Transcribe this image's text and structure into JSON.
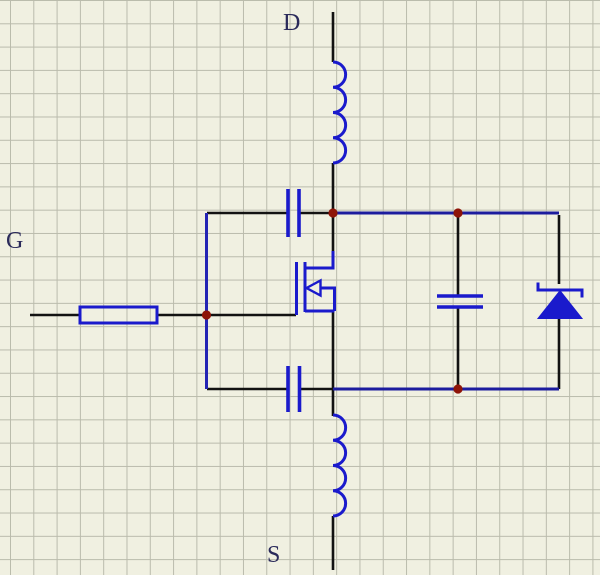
{
  "labels": {
    "drain": "D",
    "gate": "G",
    "source": "S"
  },
  "colors": {
    "background": "#f0f0e1",
    "grid_line": "#babbac",
    "wire_black": "#121212",
    "wire_blue": "#1c1c9e",
    "rail_blue": "#2424b4",
    "component_blue": "#1a1acc",
    "junction_red": "#8e1408",
    "label_color": "#2a2a5a"
  },
  "components": [
    {
      "name": "inductor-drain",
      "type": "inductor"
    },
    {
      "name": "inductor-source",
      "type": "inductor"
    },
    {
      "name": "resistor-gate",
      "type": "resistor"
    },
    {
      "name": "capacitor-gate-drain",
      "type": "capacitor"
    },
    {
      "name": "capacitor-gate-source",
      "type": "capacitor"
    },
    {
      "name": "capacitor-drain-source",
      "type": "capacitor"
    },
    {
      "name": "nmos-transistor",
      "type": "n-channel MOSFET"
    },
    {
      "name": "schottky-diode",
      "type": "schottky diode"
    }
  ]
}
